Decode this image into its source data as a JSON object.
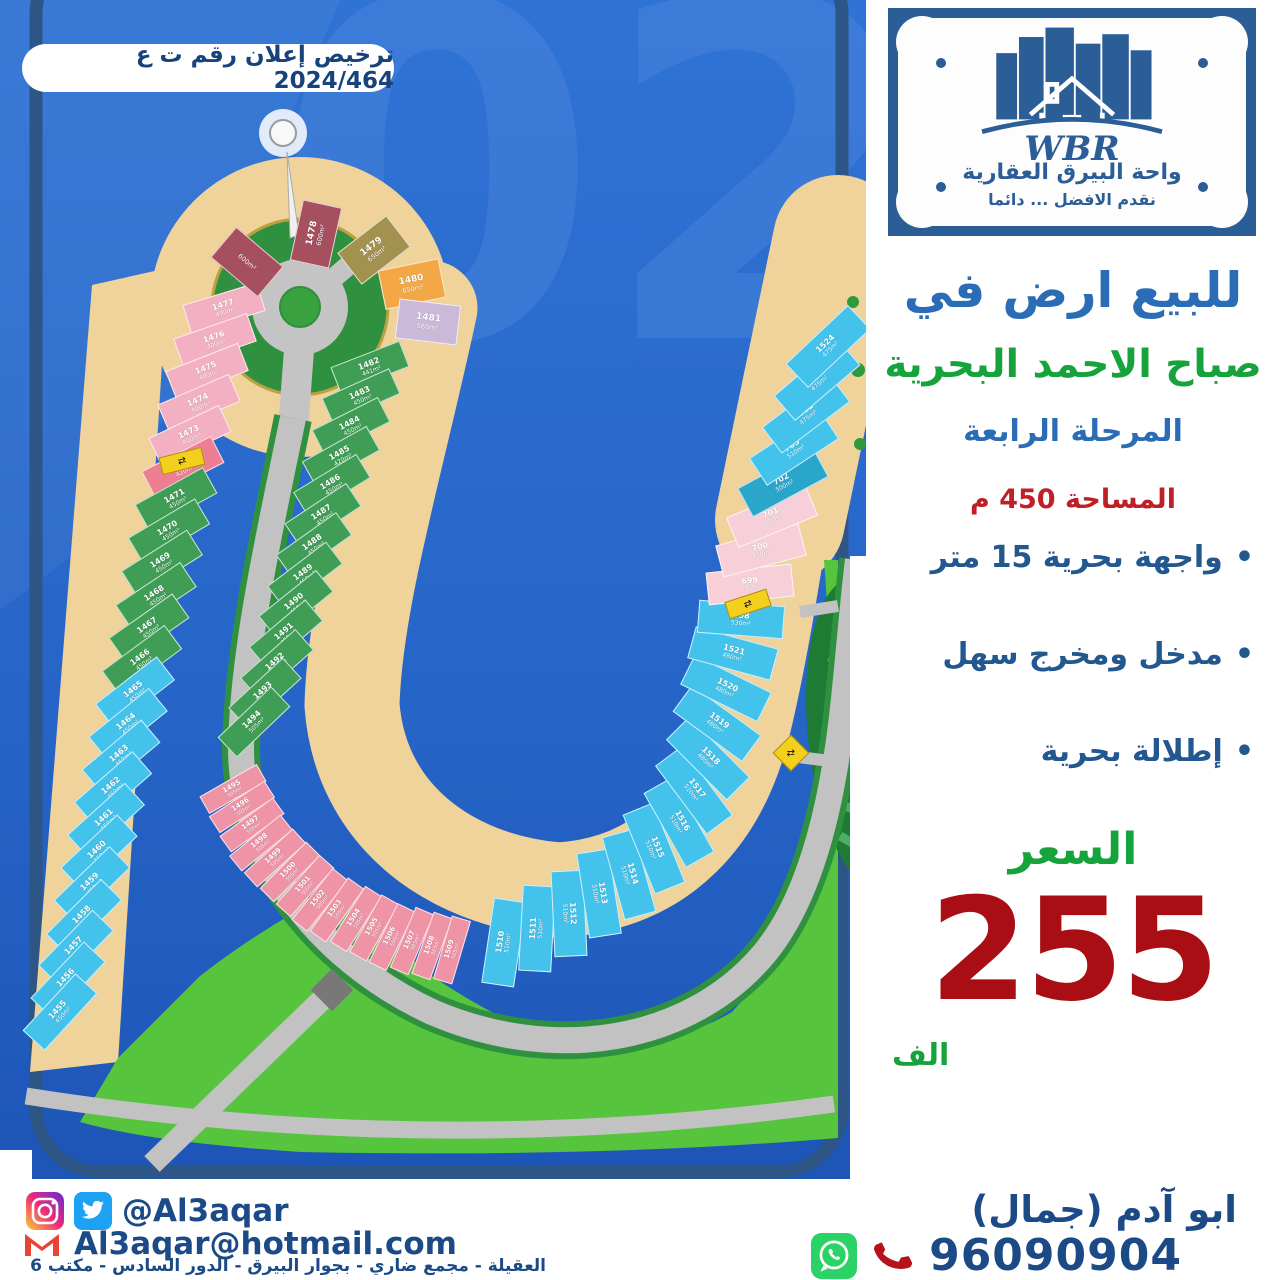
{
  "license_badge": "ترخيص إعلان رقم ت ع 2024/464",
  "logo": {
    "brand": "WBR",
    "company": "واحة البيرق العقارية",
    "tagline": "نقدم الافضل ... دائما"
  },
  "listing": {
    "title": "للبيع ارض في",
    "location": "صباح الاحمد البحرية",
    "phase": "المرحلة الرابعة",
    "area": "المساحة 450 م",
    "features": [
      "واجهة بحرية 15 متر",
      "مدخل ومخرج سهل",
      "إطلالة بحرية"
    ],
    "price_label": "السعر",
    "price": "255",
    "price_unit": "الف"
  },
  "contact": {
    "social_handle": "@Al3aqar",
    "email": "Al3aqar@hotmail.com",
    "address": "العقيلة - مجمع ضاري - بجوار البيرق - الدور السادس - مكتب 6",
    "agent": "ابو آدم (جمال)",
    "phone": "96090904"
  },
  "colors": {
    "heading_blue": "#2a6cb5",
    "green": "#17a33b",
    "red": "#a80e13",
    "navy": "#1b4a86",
    "water": "#2766c9",
    "beach": "#f0d29b",
    "park": "#56c43d"
  },
  "map": {
    "watermark": "02",
    "palette": {
      "pink": "#f3b0c2",
      "rose": "#ee7e91",
      "rosepink": "#ef93a6",
      "green": "#3f9d56",
      "cyan": "#43c3ec",
      "teal": "#2ba6cb",
      "maroon": "#a64f5f",
      "khaki": "#a3914f",
      "orange": "#f4a845",
      "lavender": "#cbb9da",
      "palepink": "#f7cfd9"
    },
    "bands": [
      {
        "name": "west-row",
        "w": 78,
        "h": 30,
        "fs": [
          8,
          6
        ],
        "focus": [
          900,
          100
        ],
        "path": [
          [
            228,
            292
          ],
          [
            186,
            452
          ],
          [
            150,
            622
          ],
          [
            118,
            768
          ],
          [
            84,
            918
          ],
          [
            56,
            1028
          ]
        ],
        "plots": [
          [
            "1477",
            "pink",
            "400m²"
          ],
          [
            "1476",
            "pink",
            "400m²"
          ],
          [
            "1475",
            "pink",
            "400m²"
          ],
          [
            "1474",
            "pink",
            "400m²"
          ],
          [
            "1473",
            "pink",
            "400m²"
          ],
          [
            "1472",
            "rose",
            "420m²"
          ],
          [
            "1471",
            "green",
            "450m²"
          ],
          [
            "1470",
            "green",
            "450m²"
          ],
          [
            "1469",
            "green",
            "450m²"
          ],
          [
            "1468",
            "green",
            "450m²"
          ],
          [
            "1467",
            "green",
            "450m²"
          ],
          [
            "1466",
            "green",
            "450m²"
          ],
          [
            "1465",
            "cyan",
            "450m²"
          ],
          [
            "1464",
            "cyan",
            "450m²"
          ],
          [
            "1463",
            "cyan",
            "450m²"
          ],
          [
            "1462",
            "cyan",
            "450m²"
          ],
          [
            "1461",
            "cyan",
            "450m²"
          ],
          [
            "1460",
            "cyan",
            "450m²"
          ],
          [
            "1459",
            "cyan",
            "450m²"
          ],
          [
            "1458",
            "cyan",
            "450m²"
          ],
          [
            "1457",
            "cyan",
            "450m²"
          ],
          [
            "1456",
            "cyan",
            "450m²"
          ],
          [
            "1455",
            "cyan",
            "450m²"
          ]
        ]
      },
      {
        "name": "inner-row",
        "w": 74,
        "h": 28,
        "fs": [
          8,
          6
        ],
        "focus": [
          800,
          200
        ],
        "path": [
          [
            375,
            352
          ],
          [
            340,
            460
          ],
          [
            310,
            560
          ],
          [
            278,
            660
          ],
          [
            248,
            736
          ]
        ],
        "plots": [
          [
            "1482",
            "green",
            "441m²"
          ],
          [
            "1483",
            "green",
            "450m²"
          ],
          [
            "1484",
            "green",
            "450m²"
          ],
          [
            "1485",
            "green",
            "420m²"
          ],
          [
            "1486",
            "green",
            "450m²"
          ],
          [
            "1487",
            "green",
            "450m²"
          ],
          [
            "1488",
            "green",
            "450m²"
          ],
          [
            "1489",
            "green",
            "450m²"
          ],
          [
            "1490",
            "green",
            "450m²"
          ],
          [
            "1491",
            "green",
            "450m²"
          ],
          [
            "1492",
            "green",
            "450m²"
          ],
          [
            "1493",
            "green",
            "500m²"
          ],
          [
            "1494",
            "green",
            "505m²"
          ]
        ]
      },
      {
        "name": "lagoon-arc",
        "w": 66,
        "h": 20,
        "fs": [
          7,
          5
        ],
        "focus": [
          555,
          605
        ],
        "path": [
          [
            228,
            780
          ],
          [
            262,
            845
          ],
          [
            322,
            902
          ],
          [
            392,
            937
          ],
          [
            462,
            952
          ]
        ],
        "plots": [
          [
            "1495",
            "rosepink",
            "505m²"
          ],
          [
            "1496",
            "rosepink",
            "505m²"
          ],
          [
            "1497",
            "rosepink",
            "505m²"
          ],
          [
            "1498",
            "rosepink",
            "505m²"
          ],
          [
            "1499",
            "rosepink",
            "505m²"
          ],
          [
            "1500",
            "rosepink",
            "505m²"
          ],
          [
            "1501",
            "rosepink",
            "505m²"
          ],
          [
            "1502",
            "rosepink",
            "505m²"
          ],
          [
            "1503",
            "rosepink",
            "505m²"
          ],
          [
            "1504",
            "rosepink",
            "505m²"
          ],
          [
            "1505",
            "rosepink",
            "505m²"
          ],
          [
            "1506",
            "rosepink",
            "505m²"
          ],
          [
            "1507",
            "rosepink",
            "505m²"
          ],
          [
            "1508",
            "rosepink",
            "505m²"
          ],
          [
            "1509",
            "rosepink",
            "505m²"
          ]
        ]
      },
      {
        "name": "east-row",
        "w": 86,
        "h": 33,
        "fs": [
          8,
          6
        ],
        "focus": [
          555,
          605
        ],
        "path": [
          [
            488,
            950
          ],
          [
            558,
            920
          ],
          [
            628,
            876
          ],
          [
            678,
            824
          ],
          [
            706,
            766
          ],
          [
            722,
            706
          ],
          [
            734,
            650
          ],
          [
            748,
            592
          ],
          [
            768,
            528
          ],
          [
            790,
            462
          ],
          [
            812,
            396
          ],
          [
            834,
            330
          ]
        ],
        "plots": [
          [
            "1510",
            "cyan",
            "510m²"
          ],
          [
            "1511",
            "cyan",
            "510m²"
          ],
          [
            "1512",
            "cyan",
            "510m²"
          ],
          [
            "1513",
            "cyan",
            "510m²"
          ],
          [
            "1514",
            "cyan",
            "510m²"
          ],
          [
            "1515",
            "cyan",
            "510m²"
          ],
          [
            "1516",
            "cyan",
            "510m²"
          ],
          [
            "1517",
            "cyan",
            "510m²"
          ],
          [
            "1518",
            "cyan",
            "480m²"
          ],
          [
            "1519",
            "cyan",
            "480m²"
          ],
          [
            "1520",
            "cyan",
            "480m²"
          ],
          [
            "1521",
            "cyan",
            "480m²"
          ],
          [
            "698",
            "cyan",
            "530m²"
          ],
          [
            "699",
            "palepink",
            "490m²"
          ],
          [
            "700",
            "palepink",
            "490m²"
          ],
          [
            "701",
            "palepink",
            "490m²"
          ],
          [
            "702",
            "teal",
            "500m²"
          ],
          [
            "703",
            "cyan",
            "510m²"
          ],
          [
            "1522",
            "cyan",
            "475m²"
          ],
          [
            "1523",
            "cyan",
            "475m²"
          ],
          [
            "1524",
            "cyan",
            "475m²"
          ]
        ]
      }
    ],
    "loop": {
      "center": [
        300,
        307
      ],
      "w": 62,
      "h": 40,
      "fs": [
        9,
        6.5
      ],
      "plots": [
        [
          "",
          "maroon",
          "600m²",
          247,
          262
        ],
        [
          "1478",
          "maroon",
          "600m²",
          316,
          234
        ],
        [
          "1479",
          "khaki",
          "650m²",
          374,
          250
        ],
        [
          "1480",
          "orange",
          "650m²",
          412,
          284
        ],
        [
          "1481",
          "lavender",
          "560m²",
          428,
          322
        ]
      ]
    },
    "signs": [
      {
        "x": 182,
        "y": 461,
        "rot": -14,
        "shape": "rect",
        "glyph": "⇄"
      },
      {
        "x": 748,
        "y": 604,
        "rot": -18,
        "shape": "rect",
        "glyph": "⇄"
      },
      {
        "x": 791,
        "y": 753,
        "rot": 45,
        "shape": "diamond",
        "glyph": "⇄"
      }
    ]
  }
}
